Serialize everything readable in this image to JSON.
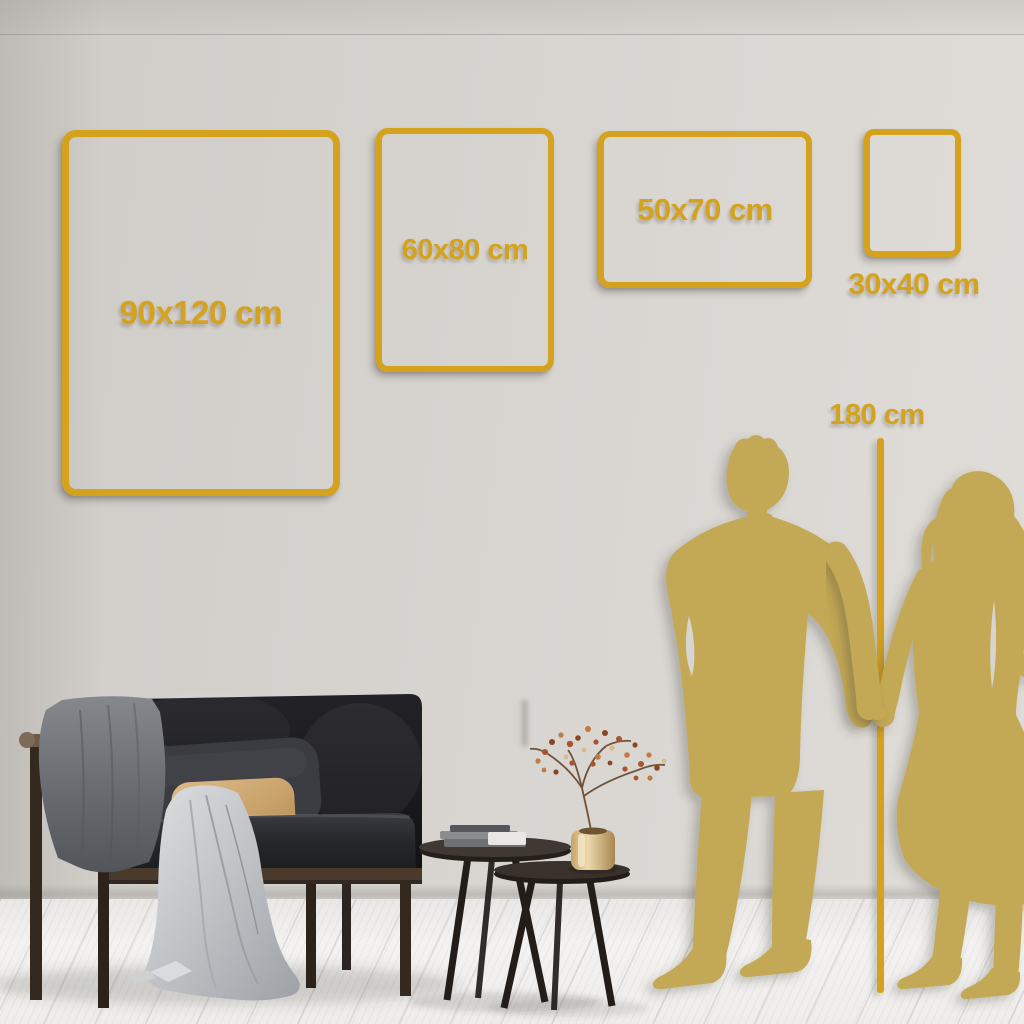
{
  "size_guide": {
    "frames": [
      {
        "label": "90x120 cm"
      },
      {
        "label": "60x80 cm"
      },
      {
        "label": "50x70 cm"
      },
      {
        "label": "30x40 cm"
      }
    ],
    "height_reference": {
      "label": "180 cm"
    }
  },
  "colors": {
    "accent_gold": "#d5a21e",
    "silhouette_gold": "#c3a855",
    "wall": "#d7d4d0",
    "floor": "#f2f1ef"
  },
  "scene": {
    "objects": [
      "dark-velvet-sofa",
      "gray-throw-blanket",
      "light-draped-cloth",
      "dark-pillow",
      "tan-pillow",
      "nesting-coffee-tables",
      "book-stack",
      "brass-vase",
      "dried-branch-decor",
      "man-and-woman-silhouette",
      "height-measure-line"
    ]
  }
}
